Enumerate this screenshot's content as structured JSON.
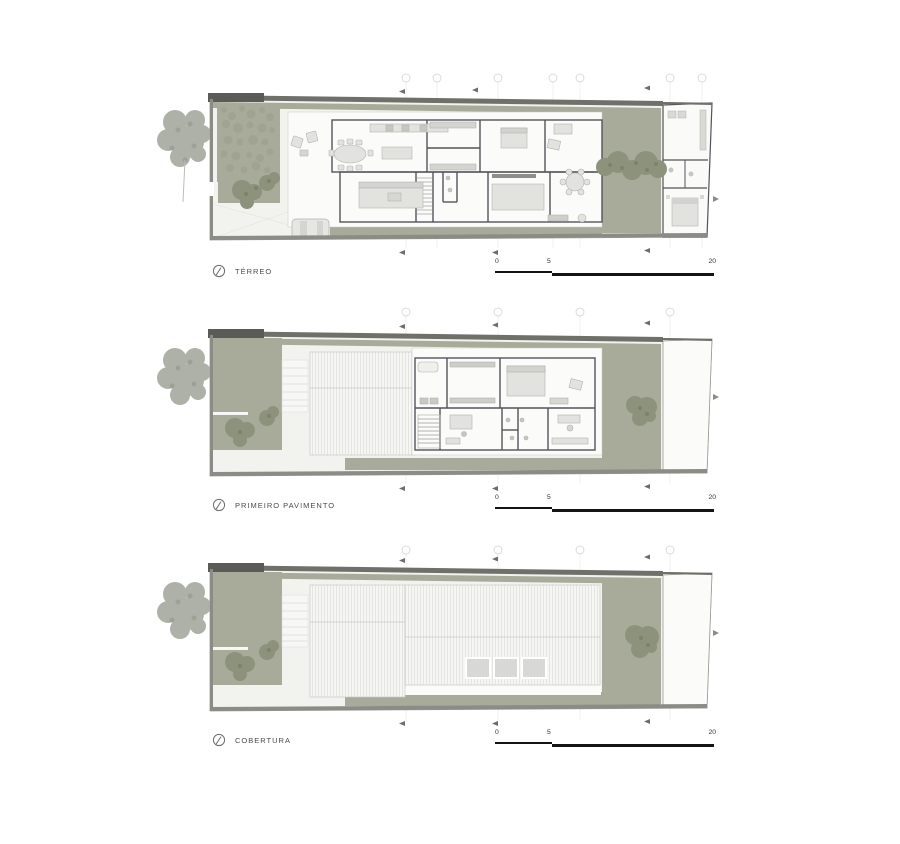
{
  "plans": [
    {
      "id": "terreo",
      "label": "TÉRREO"
    },
    {
      "id": "primeiro-pavimento",
      "label": "PRIMEIRO PAVIMENTO"
    },
    {
      "id": "cobertura",
      "label": "COBERTURA"
    }
  ],
  "scalebar": {
    "start": "0",
    "mid": "5",
    "end": "20"
  },
  "colors": {
    "vegetation": "#a8ab99",
    "canopy_dark": "#8d927c",
    "canopy_gray": "#a6a99e",
    "wall_dark": "#6f706a",
    "wall_corner": "#5a5b56",
    "wall_light": "#8b8c86",
    "site_fill": "#f2f2ef",
    "plate_fill": "#fbfbfa",
    "interior_wall": "#53545a",
    "scalebar_black": "#141414",
    "label_text": "#4a4a4a"
  }
}
